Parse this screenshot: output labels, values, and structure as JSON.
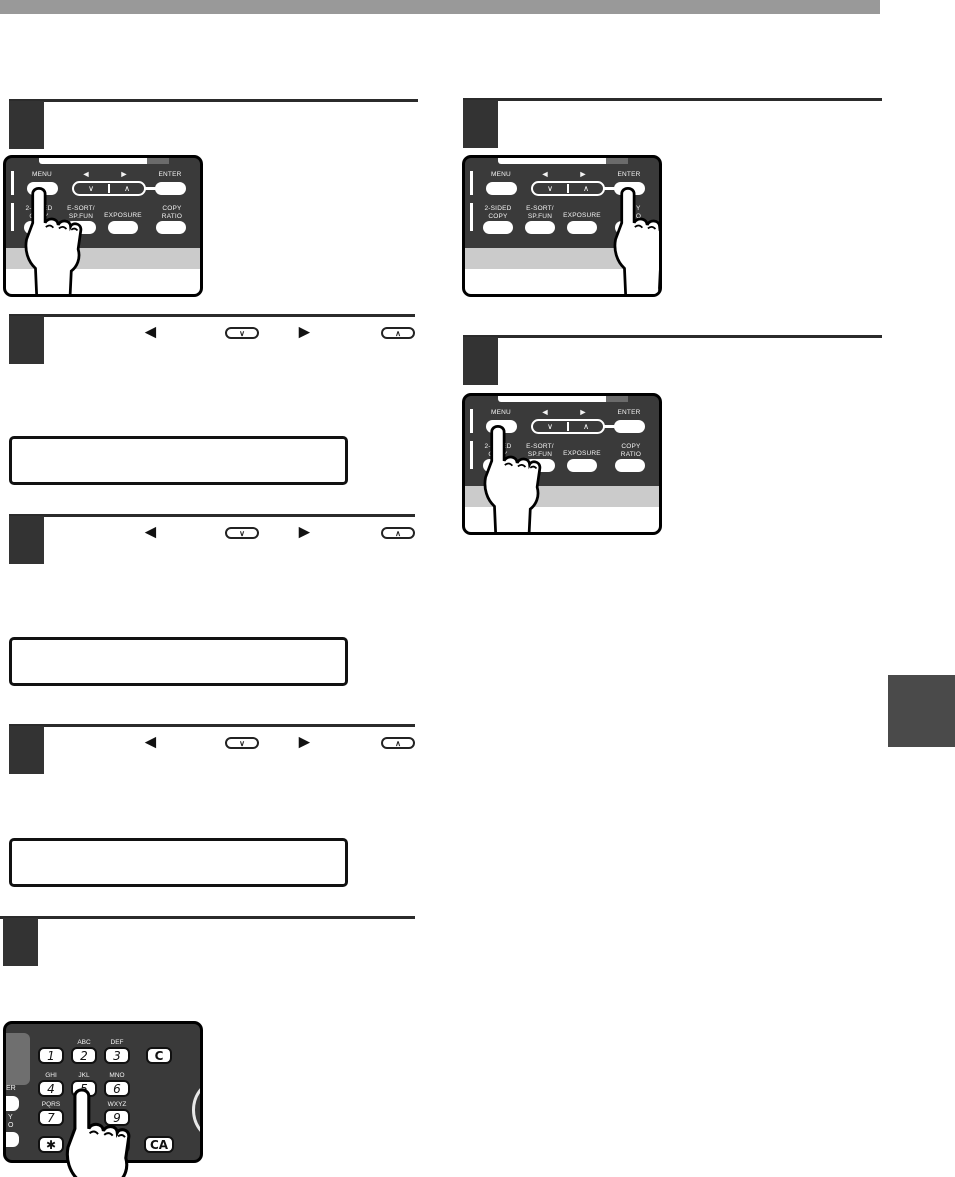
{
  "page": {
    "top_bar_color": "#999999",
    "side_tab_color": "#4a4a4a",
    "step_square_color": "#333333"
  },
  "step_icons": {
    "left_arrow": "◄",
    "right_arrow": "►",
    "down_key_glyph": "∨",
    "up_key_glyph": "∧"
  },
  "control_panel": {
    "menu": "MENU",
    "enter": "ENTER",
    "left_arrow": "◄",
    "right_arrow": "►",
    "down_key_glyph": "∨",
    "up_key_glyph": "∧",
    "buttons_row2": [
      {
        "line1": "2-SIDED",
        "line2": "COPY"
      },
      {
        "line1": "E-SORT/",
        "line2": "SP.FUN"
      },
      {
        "line1": "EXPOSURE",
        "line2": ""
      },
      {
        "line1": "COPY",
        "line2": "RATIO"
      }
    ]
  },
  "keypad": {
    "row1": [
      {
        "digit": "1",
        "letters": ""
      },
      {
        "digit": "2",
        "letters": "ABC"
      },
      {
        "digit": "3",
        "letters": "DEF"
      }
    ],
    "row2": [
      {
        "digit": "4",
        "letters": "GHI"
      },
      {
        "digit": "5",
        "letters": "JKL"
      },
      {
        "digit": "6",
        "letters": "MNO"
      }
    ],
    "row3": [
      {
        "digit": "7",
        "letters": "PQRS"
      },
      {
        "digit": "9",
        "letters": "WXYZ"
      }
    ],
    "star": "✱",
    "hash": "#",
    "hash_letters": "@.-",
    "clear": "C",
    "clear_all": "CA",
    "edge_labels": [
      "ER",
      "Y",
      "O"
    ]
  }
}
